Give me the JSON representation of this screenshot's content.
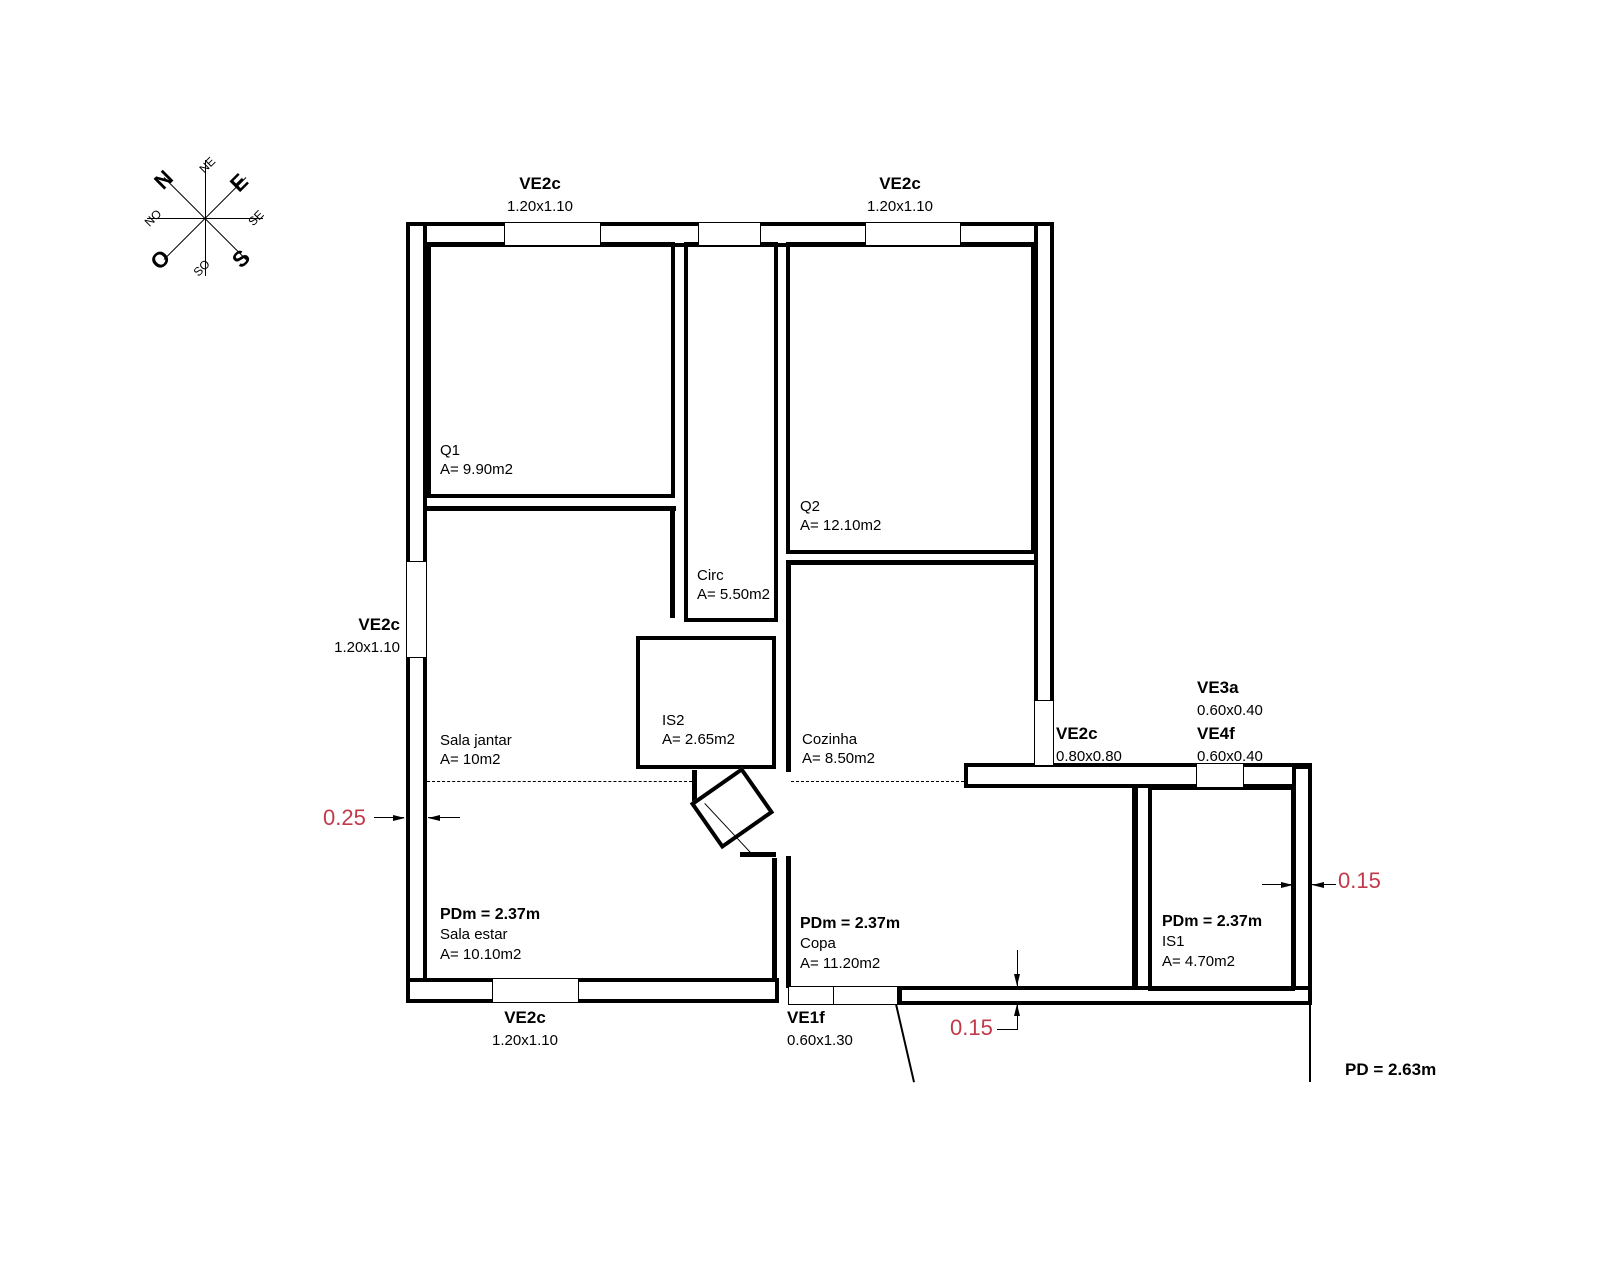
{
  "compass": {
    "n": "N",
    "ne": "NE",
    "e": "E",
    "se": "SE",
    "s": "S",
    "so": "SO",
    "o": "O",
    "no": "NO"
  },
  "windows": {
    "top_left": {
      "code": "VE2c",
      "size": "1.20x1.10"
    },
    "top_right": {
      "code": "VE2c",
      "size": "1.20x1.10"
    },
    "left": {
      "code": "VE2c",
      "size": "1.20x1.10"
    },
    "bottom": {
      "code": "VE2c",
      "size": "1.20x1.10"
    },
    "entry": {
      "code": "VE1f",
      "size": "0.60x1.30"
    },
    "right": {
      "code": "VE2c",
      "size": "0.80x0.80"
    },
    "ve3a": {
      "code": "VE3a",
      "size": "0.60x0.40"
    },
    "ve4f": {
      "code": "VE4f",
      "size": "0.60x0.40"
    }
  },
  "rooms": {
    "q1": {
      "name": "Q1",
      "area": "A= 9.90m2"
    },
    "q2": {
      "name": "Q2",
      "area": "A= 12.10m2"
    },
    "circ": {
      "name": "Circ",
      "area": "A= 5.50m2"
    },
    "is2": {
      "name": "IS2",
      "area": "A= 2.65m2"
    },
    "sala_jantar": {
      "name": "Sala jantar",
      "area": "A= 10m2"
    },
    "cozinha": {
      "name": "Cozinha",
      "area": "A= 8.50m2"
    },
    "sala_estar": {
      "name": "Sala estar",
      "area": "A= 10.10m2",
      "pdm": "PDm = 2.37m"
    },
    "copa": {
      "name": "Copa",
      "area": "A= 11.20m2",
      "pdm": "PDm = 2.37m"
    },
    "is1": {
      "name": "IS1",
      "area": "A= 4.70m2",
      "pdm": "PDm = 2.37m"
    }
  },
  "dimensions": {
    "left_wall": "0.25",
    "right_wall": "0.15",
    "bottom_wall": "0.15"
  },
  "notes": {
    "ceiling_height": "PD = 2.63m"
  },
  "colors": {
    "dimension_red": "#c13a4a",
    "line": "#000000"
  }
}
